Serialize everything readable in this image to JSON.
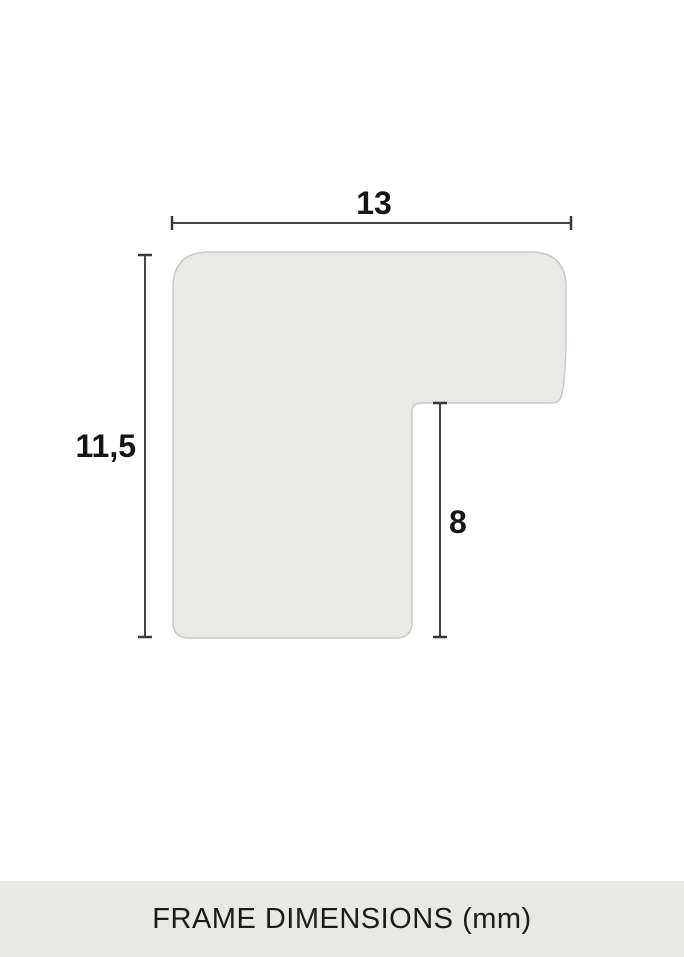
{
  "diagram": {
    "name": "frame-moulding-profile-cross-section",
    "dimensions": {
      "width": {
        "value": "13"
      },
      "height": {
        "value": "11,5"
      },
      "rabbet": {
        "value": "8"
      }
    },
    "unit": "mm"
  },
  "footer": {
    "caption": "FRAME DIMENSIONS (mm)"
  },
  "colors": {
    "canvas_bg": "#ffffff",
    "profile_fill": "#e9e9e5",
    "profile_stroke": "#c9c9c5",
    "dimension_line": "#454545",
    "label_text": "#161616",
    "footer_bg": "#e8e8e4",
    "footer_text": "#1b1b1b"
  }
}
